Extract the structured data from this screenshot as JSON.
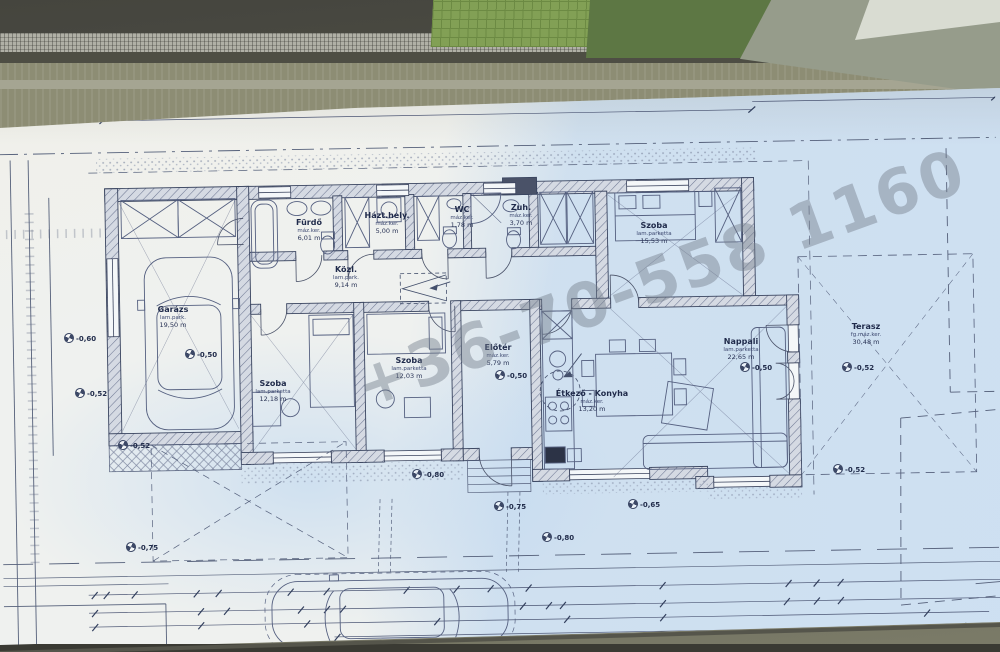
{
  "watermark": {
    "text": "+36-70-558 1160"
  },
  "plan": {
    "rooms": [
      {
        "t1": "Garázs",
        "t2": "lam.park.",
        "t3": "19,50 m",
        "x": 173,
        "y": 305
      },
      {
        "t1": "Fürdő",
        "t2": "máz.ker.",
        "t3": "6,01 m",
        "x": 309,
        "y": 218
      },
      {
        "t1": "Házt.hely.",
        "t2": "máz.ker.",
        "t3": "5,00 m",
        "x": 387,
        "y": 211
      },
      {
        "t1": "WC",
        "t2": "máz.ker.",
        "t3": "1,78 m",
        "x": 462,
        "y": 205
      },
      {
        "t1": "Zuh.",
        "t2": "máz.ker.",
        "t3": "3,70 m",
        "x": 521,
        "y": 203
      },
      {
        "t1": "Szoba",
        "t2": "lam.parketta",
        "t3": "15,53 m",
        "x": 654,
        "y": 221
      },
      {
        "t1": "Közl.",
        "t2": "lam.park.",
        "t3": "9,14 m",
        "x": 346,
        "y": 265
      },
      {
        "t1": "Szoba",
        "t2": "lam.parketta",
        "t3": "12,18 m",
        "x": 273,
        "y": 379
      },
      {
        "t1": "Szoba",
        "t2": "lam.parketta",
        "t3": "12,03 m",
        "x": 409,
        "y": 356
      },
      {
        "t1": "Előtér",
        "t2": "máz.ker.",
        "t3": "5,79 m",
        "x": 498,
        "y": 343
      },
      {
        "t1": "Étkező - Konyha",
        "t2": "máz.ker.",
        "t3": "13,20 m",
        "x": 592,
        "y": 389
      },
      {
        "t1": "Nappali",
        "t2": "lam.parketta",
        "t3": "22,65 m",
        "x": 741,
        "y": 337
      },
      {
        "t1": "Terasz",
        "t2": "fg.máz.ker.",
        "t3": "30,48 m",
        "x": 866,
        "y": 322
      }
    ],
    "dims": [
      {
        "t": "20,15",
        "x": 404,
        "y": 106,
        "r": -1.2
      },
      {
        "t": "4,00",
        "x": 856,
        "y": 93,
        "r": -1.2
      },
      {
        "t": "3,35",
        "x": 752,
        "y": 149,
        "r": -1.2
      },
      {
        "t": "15",
        "x": 90,
        "y": 590,
        "r": -1.2
      },
      {
        "t": "30",
        "x": 117,
        "y": 589,
        "r": -1.2
      },
      {
        "t": "3,00",
        "x": 152,
        "y": 589,
        "r": -1.2
      },
      {
        "t": "25",
        "x": 196,
        "y": 588,
        "r": -1.2
      },
      {
        "t": "3,60",
        "x": 280,
        "y": 587,
        "r": -1.2
      },
      {
        "t": "10",
        "x": 320,
        "y": 586,
        "r": -1.2
      },
      {
        "t": "3,70",
        "x": 400,
        "y": 585,
        "r": -1.2
      },
      {
        "t": "10",
        "x": 456,
        "y": 584,
        "r": -1.2
      },
      {
        "t": "1,80",
        "x": 490,
        "y": 583,
        "r": -1.2
      },
      {
        "t": "10",
        "x": 528,
        "y": 583,
        "r": -1.2
      },
      {
        "t": "7,20",
        "x": 664,
        "y": 581,
        "r": -1.2
      },
      {
        "t": "30",
        "x": 790,
        "y": 578,
        "r": -1.2
      },
      {
        "t": "50",
        "x": 816,
        "y": 577,
        "r": -1.2
      },
      {
        "t": "3,25",
        "x": 150,
        "y": 611,
        "r": -1.2
      },
      {
        "t": "15",
        "x": 197,
        "y": 610,
        "r": -1.2
      },
      {
        "t": "10",
        "x": 222,
        "y": 609,
        "r": -1.2
      },
      {
        "t": "3,50",
        "x": 258,
        "y": 608,
        "r": -1.2
      },
      {
        "t": "30",
        "x": 299,
        "y": 607,
        "r": -1.2
      },
      {
        "t": "15",
        "x": 326,
        "y": 607,
        "r": -1.2
      },
      {
        "t": "4,90",
        "x": 436,
        "y": 604,
        "r": -1.2
      },
      {
        "t": "15",
        "x": 519,
        "y": 603,
        "r": -1.2
      },
      {
        "t": "30",
        "x": 545,
        "y": 602,
        "r": -1.2
      },
      {
        "t": "7,20",
        "x": 665,
        "y": 600,
        "r": -1.2
      },
      {
        "t": "30",
        "x": 784,
        "y": 597,
        "r": -1.2
      },
      {
        "t": "50",
        "x": 815,
        "y": 596,
        "r": -1.2
      },
      {
        "t": "3,25",
        "x": 152,
        "y": 626,
        "r": -1.2
      },
      {
        "t": "3,60",
        "x": 264,
        "y": 624,
        "r": -1.2
      },
      {
        "t": "4,90",
        "x": 434,
        "y": 621,
        "r": -1.2
      },
      {
        "t": "8,10",
        "x": 668,
        "y": 617,
        "r": -1.2
      },
      {
        "t": "5,35",
        "x": 150,
        "y": 642,
        "r": -1.2
      },
      {
        "t": "20,15",
        "x": 618,
        "y": 634,
        "r": -1.2
      },
      {
        "t": "3,0",
        "x": 14,
        "y": 222,
        "r": -90
      },
      {
        "t": "6,50",
        "x": 5,
        "y": 332,
        "r": -90
      },
      {
        "t": "7,30",
        "x": 24,
        "y": 342,
        "r": -90
      },
      {
        "t": "1,65",
        "x": 42,
        "y": 248,
        "r": -90
      },
      {
        "t": "1,95",
        "x": 41,
        "y": 302,
        "r": -90
      },
      {
        "t": "2,5",
        "x": 42,
        "y": 322,
        "r": -90
      },
      {
        "t": "4,05",
        "x": 34,
        "y": 394,
        "r": -90
      },
      {
        "t": "3,00",
        "x": 145,
        "y": 425,
        "r": -1.2
      },
      {
        "t": "90",
        "x": 240,
        "y": 271
      },
      {
        "t": "210",
        "x": 240,
        "y": 281
      },
      {
        "t": "90",
        "x": 543,
        "y": 272
      },
      {
        "t": "210",
        "x": 543,
        "y": 283
      },
      {
        "t": "180",
        "x": 750,
        "y": 246
      },
      {
        "t": "240",
        "x": 752,
        "y": 258
      },
      {
        "t": "90",
        "x": 814,
        "y": 328
      },
      {
        "t": "240",
        "x": 816,
        "y": 340
      },
      {
        "t": "180",
        "x": 814,
        "y": 372
      },
      {
        "t": "240",
        "x": 816,
        "y": 384
      },
      {
        "t": "180",
        "x": 652,
        "y": 537
      },
      {
        "t": "240",
        "x": 654,
        "y": 549
      },
      {
        "t": "75",
        "x": 248,
        "y": 266,
        "r": -90
      },
      {
        "t": "210",
        "x": 256,
        "y": 266,
        "r": -90
      },
      {
        "t": "75",
        "x": 404,
        "y": 266,
        "r": -90
      },
      {
        "t": "210",
        "x": 411,
        "y": 266,
        "r": -90
      },
      {
        "t": "75",
        "x": 470,
        "y": 266,
        "r": -90
      },
      {
        "t": "210",
        "x": 477,
        "y": 266,
        "r": -90
      },
      {
        "t": "90",
        "x": 592,
        "y": 516,
        "r": -90
      },
      {
        "t": "150",
        "x": 600,
        "y": 516,
        "r": -90
      },
      {
        "t": "90",
        "x": 694,
        "y": 514,
        "r": -90
      },
      {
        "t": "150",
        "x": 702,
        "y": 514,
        "r": -90
      }
    ],
    "spots": [
      {
        "t": "-0,50",
        "x": 185,
        "y": 349
      },
      {
        "t": "-0,50",
        "x": 495,
        "y": 370
      },
      {
        "t": "-0,50",
        "x": 740,
        "y": 362
      },
      {
        "t": "-0,52",
        "x": 118,
        "y": 440
      },
      {
        "t": "-0,52",
        "x": 75,
        "y": 388
      },
      {
        "t": "-0,52",
        "x": 842,
        "y": 362
      },
      {
        "t": "-0,52",
        "x": 833,
        "y": 464
      },
      {
        "t": "-0,60",
        "x": 64,
        "y": 333
      },
      {
        "t": "-0,65",
        "x": 628,
        "y": 499
      },
      {
        "t": "-0,75",
        "x": 126,
        "y": 542
      },
      {
        "t": "-0,75",
        "x": 494,
        "y": 501
      },
      {
        "t": "-0,80",
        "x": 542,
        "y": 532
      },
      {
        "t": "-0,80",
        "x": 412,
        "y": 469
      }
    ],
    "pm": [
      {
        "t": "pm: 130",
        "x": 262,
        "y": 203
      },
      {
        "t": "pm: 130",
        "x": 376,
        "y": 199
      },
      {
        "t": "pm: 130",
        "x": 446,
        "y": 196
      },
      {
        "t": "pm: 130",
        "x": 524,
        "y": 193
      },
      {
        "t": "pm: 40",
        "x": 276,
        "y": 440
      },
      {
        "t": "pm: 40",
        "x": 396,
        "y": 411
      },
      {
        "t": "pm: 40",
        "x": 574,
        "y": 467
      },
      {
        "t": "pm: 40",
        "x": 668,
        "y": 464
      }
    ],
    "notes": [
      {
        "t": "padlásfeljáró",
        "x": 455,
        "y": 274,
        "r": -1
      },
      {
        "t": "gyűrűs kút",
        "x": 583,
        "y": 348,
        "r": -1,
        "cls": "b"
      },
      {
        "t": "építési hely határa a kerítéstől mérve",
        "x": 8,
        "y": 160,
        "r": -2
      },
      {
        "t": "elbontott épület",
        "x": 888,
        "y": 585,
        "r": -1.5
      },
      {
        "t": "kontúrja",
        "x": 922,
        "y": 599,
        "r": -1.5
      }
    ]
  }
}
